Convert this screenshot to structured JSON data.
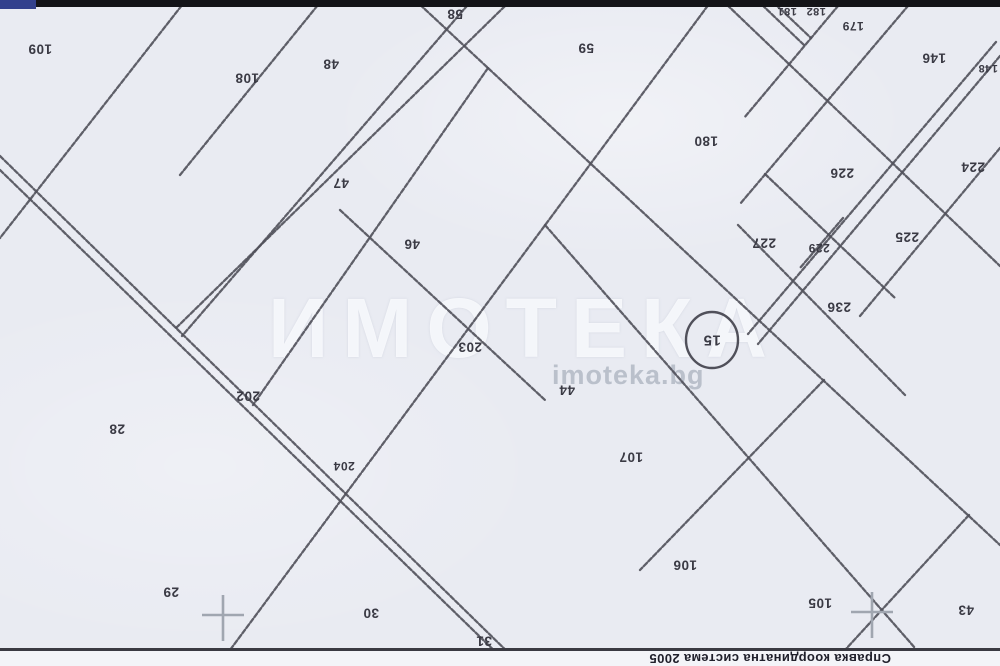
{
  "watermark": {
    "large": "ИМОТЕКА",
    "small": "imoteka.bg"
  },
  "footer": {
    "text": "Справка координатна система 2005"
  },
  "colors": {
    "paper": "#e9ebf2",
    "boundary_line": "#50505a",
    "label_text": "#3a3a44",
    "top_bar": "#141418",
    "top_bar_blue": "#33418d",
    "frame_line": "#3a3a42",
    "footer_bg": "#f3f4f8",
    "footer_text": "#20202b",
    "crosshair": "#a0a6b0",
    "watermark_large": "rgba(251,252,255,0.82)",
    "watermark_small": "rgba(148,156,172,0.55)"
  },
  "parcel_labels": [
    {
      "n": "109",
      "x": 40,
      "y": 49
    },
    {
      "n": "108",
      "x": 247,
      "y": 78
    },
    {
      "n": "48",
      "x": 331,
      "y": 64
    },
    {
      "n": "58",
      "x": 455,
      "y": 14
    },
    {
      "n": "59",
      "x": 586,
      "y": 48
    },
    {
      "n": "47",
      "x": 341,
      "y": 183
    },
    {
      "n": "46",
      "x": 412,
      "y": 244
    },
    {
      "n": "180",
      "x": 706,
      "y": 141
    },
    {
      "n": "181",
      "x": 787,
      "y": 11,
      "s": 11
    },
    {
      "n": "182",
      "x": 816,
      "y": 11,
      "s": 11
    },
    {
      "n": "179",
      "x": 853,
      "y": 26,
      "s": 12
    },
    {
      "n": "146",
      "x": 934,
      "y": 58
    },
    {
      "n": "148",
      "x": 988,
      "y": 68,
      "s": 11
    },
    {
      "n": "224",
      "x": 973,
      "y": 167
    },
    {
      "n": "226",
      "x": 842,
      "y": 173
    },
    {
      "n": "227",
      "x": 764,
      "y": 243
    },
    {
      "n": "229",
      "x": 819,
      "y": 248,
      "s": 12
    },
    {
      "n": "225",
      "x": 907,
      "y": 237
    },
    {
      "n": "236",
      "x": 839,
      "y": 307
    },
    {
      "n": "203",
      "x": 470,
      "y": 347
    },
    {
      "n": "44",
      "x": 567,
      "y": 390
    },
    {
      "n": "202",
      "x": 248,
      "y": 396
    },
    {
      "n": "204",
      "x": 344,
      "y": 466,
      "s": 12
    },
    {
      "n": "28",
      "x": 117,
      "y": 429
    },
    {
      "n": "29",
      "x": 171,
      "y": 592
    },
    {
      "n": "30",
      "x": 371,
      "y": 613
    },
    {
      "n": "31",
      "x": 484,
      "y": 641
    },
    {
      "n": "107",
      "x": 631,
      "y": 457
    },
    {
      "n": "106",
      "x": 685,
      "y": 565
    },
    {
      "n": "105",
      "x": 820,
      "y": 603
    },
    {
      "n": "43",
      "x": 966,
      "y": 610
    }
  ],
  "circled_parcel": {
    "n": "15",
    "x": 712,
    "y": 340,
    "rx": 26,
    "ry": 28
  },
  "map_lines": {
    "boundaries": [
      [
        186,
        0,
        0,
        238
      ],
      [
        322,
        0,
        180,
        175
      ],
      [
        505,
        6,
        175,
        329
      ],
      [
        472,
        0,
        182,
        336
      ],
      [
        488,
        68,
        253,
        405
      ],
      [
        712,
        0,
        230,
        650
      ],
      [
        415,
        0,
        1000,
        545
      ],
      [
        722,
        0,
        1000,
        266
      ],
      [
        757,
        0,
        805,
        46
      ],
      [
        771,
        0,
        811,
        38
      ],
      [
        843,
        0,
        744,
        118
      ],
      [
        913,
        0,
        740,
        204
      ],
      [
        1000,
        148,
        860,
        316
      ],
      [
        765,
        174,
        895,
        298
      ],
      [
        738,
        225,
        905,
        395
      ],
      [
        843,
        218,
        800,
        268
      ],
      [
        545,
        225,
        915,
        648
      ],
      [
        340,
        210,
        545,
        400
      ],
      [
        824,
        380,
        640,
        570
      ],
      [
        969,
        515,
        845,
        650
      ]
    ],
    "roads": [
      [
        0,
        156,
        522,
        666
      ],
      [
        0,
        170,
        510,
        666
      ],
      [
        996,
        42,
        748,
        334
      ],
      [
        1000,
        56,
        758,
        344
      ]
    ]
  },
  "crosshairs": [
    {
      "x": 223,
      "y": 617
    },
    {
      "x": 872,
      "y": 614
    }
  ]
}
